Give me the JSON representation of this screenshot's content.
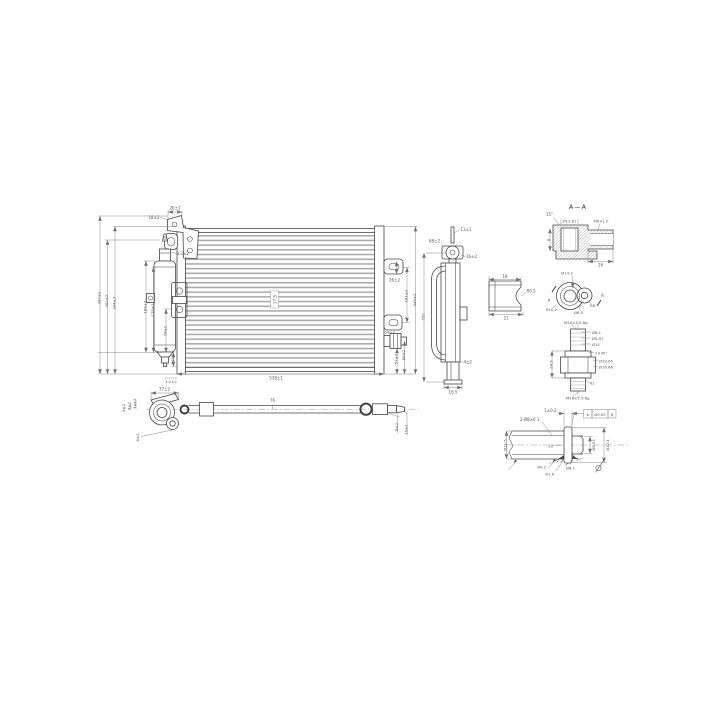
{
  "drawing": {
    "type": "engineering-drawing",
    "subject": "condenser-assembly",
    "background": "#ffffff",
    "line_color": "#474747",
    "dim_color": "#7a7a7a",
    "text_color": "#555555"
  },
  "front": {
    "dims": {
      "bracket_width": "20±1",
      "bracket_offset": "18±2",
      "valve_height": "8.2±2",
      "overall_height": "397±2",
      "height_2": "362±2",
      "core_height": "344±2",
      "drier_height": "184±2",
      "drier_body": "175±2",
      "lower_left": "78±2",
      "drier_outlet": "14±2",
      "tab_slot": "26±2",
      "tab_pitch": "161±2",
      "right_height": "345±2",
      "fitting_offset": "54±2",
      "fitting_drop": "52±2",
      "lower_right": "88±2",
      "overall_width": "538±1",
      "bottom_offset": "3.2±2",
      "fin_pitch": "17.5"
    }
  },
  "side": {
    "dims": {
      "top_pin": "13±1",
      "bracket": "68±2",
      "valve_offset": "16±2",
      "pipe_length": "252",
      "foot_gap": "4±2",
      "depth": "16.5"
    }
  },
  "section_aa": {
    "title": "A—A",
    "dims": {
      "chamfer_angle": "15°",
      "bore": "Ø12.81",
      "thread": "M6×1.0",
      "depth": "8",
      "width": "16"
    }
  },
  "bracket": {
    "dims": {
      "width": "18",
      "base": "21",
      "radius": "R0.5"
    }
  },
  "flange": {
    "section_marker": "A",
    "dims": {
      "bore": "Ø14.3",
      "radius_left": "R10.2",
      "radius_right": "R8",
      "hole": "Ø6.5"
    }
  },
  "fitting": {
    "dims": {
      "thread_top": "M20×1.5-6g",
      "d1": "Ø8.1",
      "d2": "Ø5.97",
      "d3": "Ø12",
      "chamfer": "2×45°",
      "d4": "Ø19.05",
      "d5": "Ø16.66",
      "length": "24.5",
      "radius": "R1",
      "thread_bottom": "M16×1.5-6g"
    }
  },
  "pipe": {
    "dims": {
      "flange_width": "37±2",
      "l1": "14±2",
      "l2": "8±2",
      "l3": "4±2",
      "l4": "6±2",
      "mid_length": "76",
      "end_1": "8±2",
      "end_2": "10±1"
    }
  },
  "pipe_end": {
    "dims": {
      "bead_width": "1±0.2",
      "tube_note": "2-Ø8±0.1",
      "flare_angle": "20°",
      "tube_od": "Ø11.5",
      "r_fillet": "R0.2",
      "r_bead": "R1.6",
      "tube_id": "Ø8.1",
      "cone_angle": "30°",
      "d_mid": "Ø8.53",
      "bead_od": "Ø12.4"
    },
    "tolerance": {
      "symbol": "⌖",
      "value": "Ø0.05",
      "datum": "A"
    }
  }
}
